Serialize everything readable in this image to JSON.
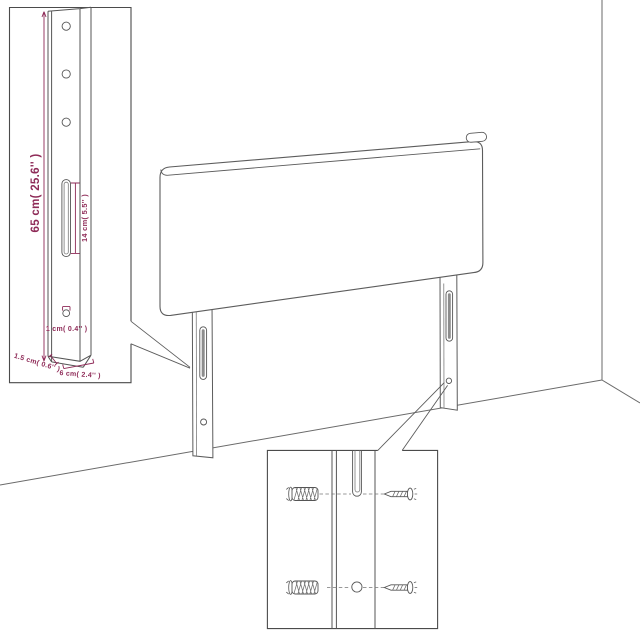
{
  "diagram": {
    "subject": "headboard-with-legs-assembly-diagram",
    "dimension_labels": {
      "leg_height": "65 cm( 25.6'' )",
      "slot_length": "14 cm( 5.5'' )",
      "hole_diameter": "1 cm( 0.4'' )",
      "leg_thickness": "1.5 cm( 0.6'' )",
      "leg_width": "6 cm( 2.4'' )"
    },
    "hardware_icons": [
      "wall-plug-icon",
      "screw-icon"
    ],
    "colors": {
      "background": "#ffffff",
      "outline": "#5c5c5c",
      "dimension_accent": "#8e2a57"
    }
  }
}
